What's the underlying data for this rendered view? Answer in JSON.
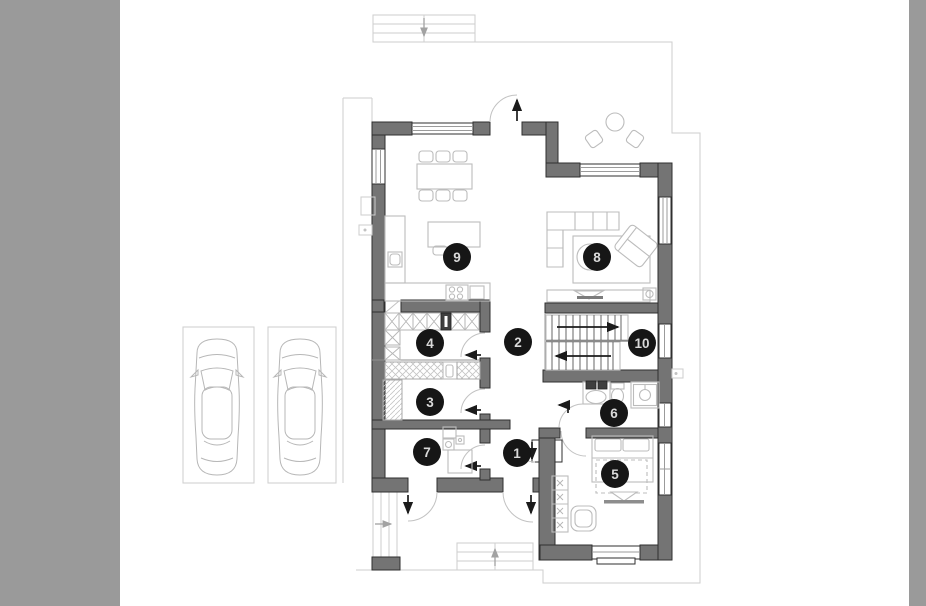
{
  "plan": {
    "markers": [
      {
        "label": "1"
      },
      {
        "label": "2"
      },
      {
        "label": "3"
      },
      {
        "label": "4"
      },
      {
        "label": "5"
      },
      {
        "label": "6"
      },
      {
        "label": "7"
      },
      {
        "label": "8"
      },
      {
        "label": "9"
      },
      {
        "label": "10"
      }
    ],
    "parking_space_count": "2",
    "colors": {
      "canvas_bg": "#ffffff",
      "sidebar": "#9a9a9a",
      "wall_fill": "#747474",
      "wall_outline": "#2f2f2f",
      "furniture_line": "#bcbcbc",
      "site_outline": "#cdcdcd",
      "marker_bg": "#161616",
      "marker_text": "#dadada",
      "arrow": "#1b1b1b"
    }
  }
}
